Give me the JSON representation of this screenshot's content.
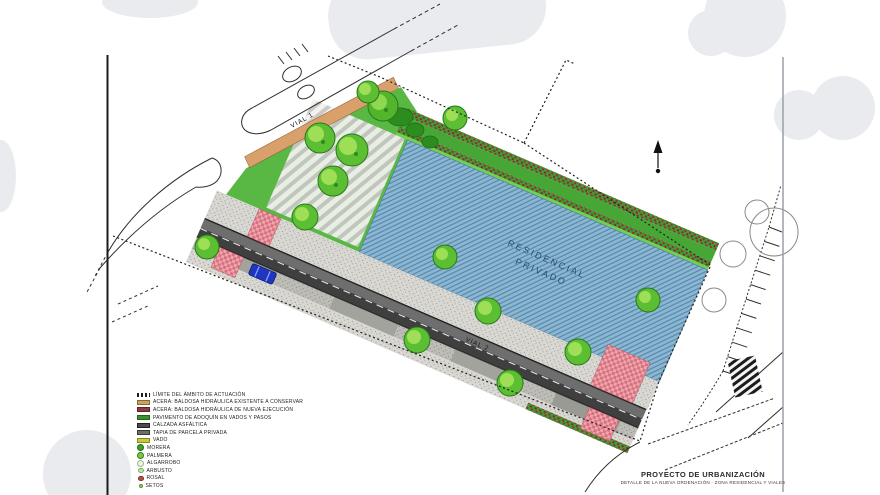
{
  "plan": {
    "vial1_label": "VIAL 1",
    "vial2_label": "VIAL 2",
    "parcel_label_line1": "RESIDENCIAL",
    "parcel_label_line2": "PRIVADO"
  },
  "title_block": {
    "title": "PROYECTO DE URBANIZACIÓN",
    "subtitle": "DETALLE DE LA NUEVA ORDENACIÓN · ZONA RESIDENCIAL Y VIALES"
  },
  "legend": {
    "items": [
      {
        "type": "dash",
        "fill": "#1d1d1d",
        "border": "#1d1d1d",
        "label": "LÍMITE DEL ÁMBITO DE ACTUACIÓN"
      },
      {
        "type": "rect",
        "fill": "#c9a366",
        "border": "#8a6a30",
        "label": "ACERA: BALDOSA HIDRÁULICA EXISTENTE A CONSERVAR"
      },
      {
        "type": "rect",
        "fill": "#8d3a42",
        "border": "#5e2228",
        "label": "ACERA: BALDOSA HIDRÁULICA DE NUEVA EJECUCIÓN"
      },
      {
        "type": "rect",
        "fill": "#3f8f33",
        "border": "#23641a",
        "label": "PAVIMENTO DE ADOQUÍN EN VADOS Y PASOS"
      },
      {
        "type": "rect",
        "fill": "#4a4a4a",
        "border": "#222222",
        "label": "CALZADA ASFÁLTICA"
      },
      {
        "type": "rect",
        "fill": "#6e6e68",
        "border": "#3a3a36",
        "label": "TAPIA DE PARCELA PRIVADA"
      },
      {
        "type": "rect",
        "fill": "#c9c93e",
        "border": "#8a8a20",
        "label": "VADO"
      },
      {
        "type": "circle-lg",
        "fill": "#3aa32a",
        "border": "#1c6b12",
        "label": "MORERA"
      },
      {
        "type": "circle-lg",
        "fill": "#7cc93f",
        "border": "#2f7d1d",
        "label": "PALMERA"
      },
      {
        "type": "circle-lg",
        "fill": "#eef5e6",
        "border": "#9ab88a",
        "label": "ALGARROBO"
      },
      {
        "type": "circle-sm",
        "fill": "#bfe3a0",
        "border": "#7fae5f",
        "label": "ARBUSTO"
      },
      {
        "type": "circle-sm",
        "fill": "#b05548",
        "border": "#7c3026",
        "label": "ROSAL"
      },
      {
        "type": "circle-xs",
        "fill": "#9fd06a",
        "border": "#55903a",
        "label": "SETOS"
      }
    ]
  },
  "colors": {
    "parcel_blue": "#8cb7d3",
    "garden_green": "#46a636",
    "flower_red": "#a12836",
    "asphalt": "#3f3f3f",
    "sidewalk_gray": "#d8d7d2",
    "paving_tan": "#d9a06c",
    "crosswalk_pink": "#eba6ae",
    "car_blue": "#2136c0",
    "watermark_gray": "#e9ebef"
  }
}
